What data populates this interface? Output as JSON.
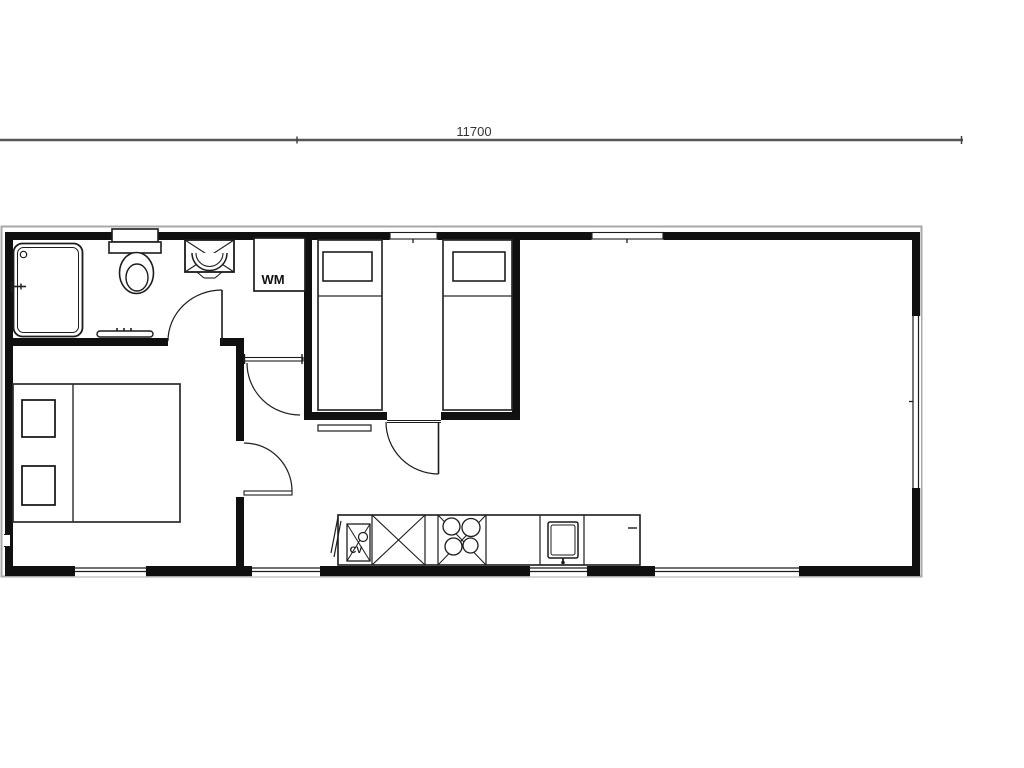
{
  "drawing": {
    "type": "floor-plan",
    "dimension": {
      "label": "11700"
    },
    "labels": {
      "washing_machine": "WM",
      "boiler": "CV"
    },
    "colors": {
      "wall": "#101010",
      "line": "#1c1c1c",
      "roof_outline": "#a8a8a8",
      "dimension_line": "#575757",
      "text": "#333333",
      "background": "#ffffff"
    },
    "fixtures": [
      "shower-tray",
      "shower-mixer",
      "toilet",
      "washbasin",
      "towel-rail",
      "washing-machine",
      "bathroom-door",
      "utility-closet-door",
      "double-bed",
      "master-bedroom-door",
      "single-bed-left",
      "single-bed-right",
      "bedroom2-door",
      "radiator",
      "kitchen-counter",
      "boiler-unit",
      "base-cabinet",
      "hob-4-burners",
      "kitchen-sink"
    ],
    "windows": {
      "top_wall": 2,
      "bottom_wall": 4,
      "right_wall": 1
    }
  }
}
